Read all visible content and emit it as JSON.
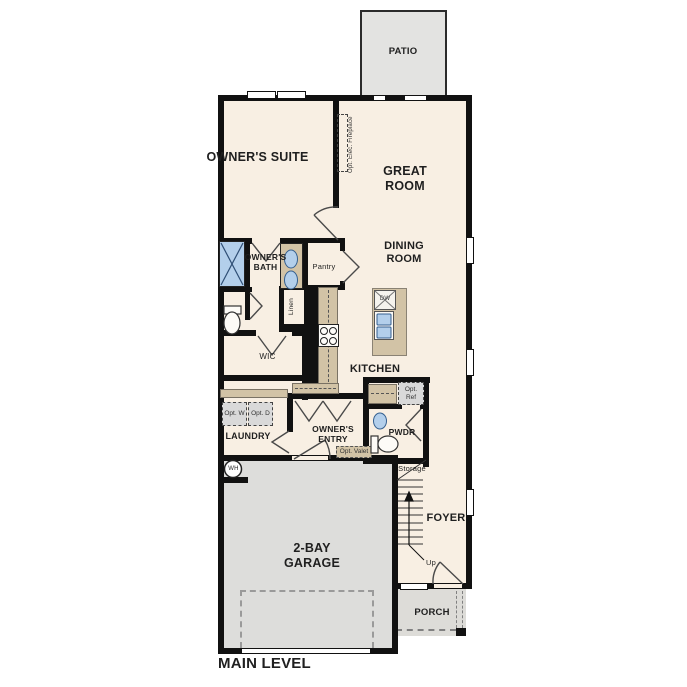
{
  "title": "MAIN LEVEL",
  "rooms": {
    "patio": "PATIO",
    "owners_suite": "OWNER'S SUITE",
    "great_room": "GREAT ROOM",
    "dining_room": "DINING ROOM",
    "owners_bath": "OWNER'S BATH",
    "pantry": "Pantry",
    "linen": "Linen",
    "wic": "WIC",
    "kitchen": "KITCHEN",
    "laundry": "LAUNDRY",
    "owners_entry": "OWNER'S ENTRY",
    "pwdr": "PWDR",
    "storage": "Storage",
    "foyer": "FOYER",
    "garage": "2-BAY GARAGE",
    "porch": "PORCH"
  },
  "annotations": {
    "fireplace": "Opt. Elec. Fireplace",
    "opt_w": "Opt. W",
    "opt_d": "Opt. D",
    "opt_ref": "Opt. Ref",
    "opt_valet": "Opt. Valet",
    "up": "Up",
    "water_heater": "WH",
    "dishwasher": "DW"
  },
  "colors": {
    "interior": "#f8efe3",
    "patio": "#e3e3e1",
    "garage": "#dddddb",
    "porch": "#dddcd8",
    "counter_tan": "#d2c3a6",
    "fixture_blue": "#b3cfeb",
    "wall": "#111111",
    "text": "#1f1f1f"
  }
}
